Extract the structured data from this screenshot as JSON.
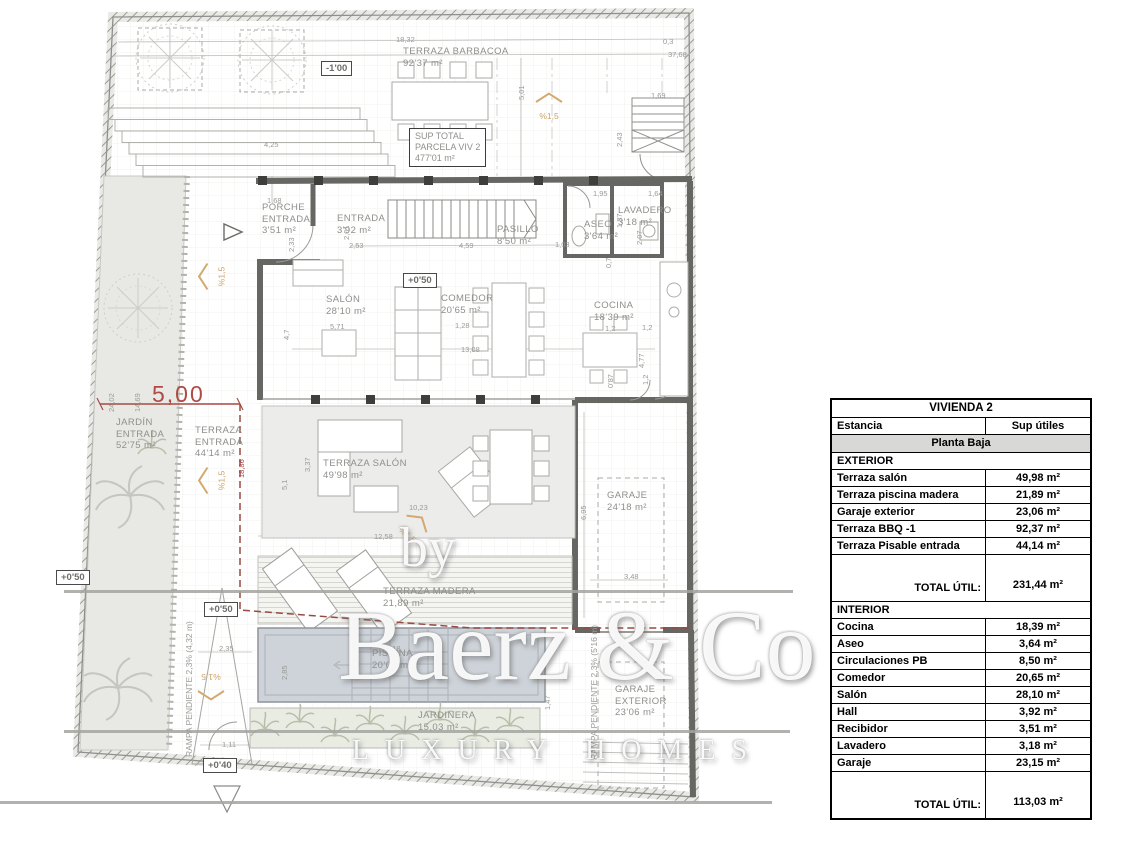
{
  "watermark": {
    "by": "by",
    "brand": "Baerz & Co",
    "tagline": "LUXURY HOMES"
  },
  "table": {
    "title": "VIVIENDA 2",
    "col_room": "Estancia",
    "col_area": "Sup útiles",
    "section_title": "Planta Baja",
    "groups": [
      {
        "header": "EXTERIOR",
        "rows": [
          [
            "Terraza salón",
            "49,98 m²"
          ],
          [
            "Terraza piscina madera",
            "21,89 m²"
          ],
          [
            "Garaje exterior",
            "23,06 m²"
          ],
          [
            "Terraza BBQ -1",
            "92,37 m²"
          ],
          [
            "Terraza Pisable entrada",
            "44,14 m²"
          ]
        ],
        "total_label": "TOTAL ÚTIL:",
        "total_value": "231,44  m²"
      },
      {
        "header": "INTERIOR",
        "rows": [
          [
            "Cocina",
            "18,39 m²"
          ],
          [
            "Aseo",
            "3,64 m²"
          ],
          [
            "Circulaciones PB",
            "8,50 m²"
          ],
          [
            "Comedor",
            "20,65 m²"
          ],
          [
            "Salón",
            "28,10 m²"
          ],
          [
            "Hall",
            "3,92 m²"
          ],
          [
            "Recibidor",
            "3,51 m²"
          ],
          [
            "Lavadero",
            "3,18 m²"
          ],
          [
            "Garaje",
            "23,15 m²"
          ]
        ],
        "total_label": "TOTAL ÚTIL:",
        "total_value": "113,03  m²"
      }
    ]
  },
  "plan": {
    "slope_text": "%1,5",
    "sup_total": {
      "lines": [
        "SUP TOTAL",
        "PARCELA VIV 2",
        "477'01 m²"
      ],
      "x": 409,
      "y": 128
    },
    "red_dim": {
      "t": "5,00",
      "x": 152,
      "y": 381
    },
    "rooms": [
      {
        "lines": [
          "TERRAZA BARBACOA",
          "92'37 m²"
        ],
        "x": 403,
        "y": 46
      },
      {
        "lines": [
          "PORCHE",
          "ENTRADA",
          "3'51 m²"
        ],
        "x": 262,
        "y": 202
      },
      {
        "lines": [
          "ENTRADA",
          "3'92 m²"
        ],
        "x": 337,
        "y": 213
      },
      {
        "lines": [
          "PASILLO",
          "8'50 m²"
        ],
        "x": 497,
        "y": 224
      },
      {
        "lines": [
          "ASEO",
          "3'64 m²"
        ],
        "x": 584,
        "y": 219
      },
      {
        "lines": [
          "LAVADERO",
          "3'18 m²"
        ],
        "x": 618,
        "y": 205
      },
      {
        "lines": [
          "SALÓN",
          "28'10 m²"
        ],
        "x": 326,
        "y": 294
      },
      {
        "lines": [
          "COMEDOR",
          "20'65 m²"
        ],
        "x": 441,
        "y": 293
      },
      {
        "lines": [
          "COCINA",
          "18'39 m²"
        ],
        "x": 594,
        "y": 300
      },
      {
        "lines": [
          "JARDÍN",
          "ENTRADA",
          "52'75 m²"
        ],
        "x": 116,
        "y": 417
      },
      {
        "lines": [
          "TERRAZA",
          "ENTRADA",
          "44'14 m²"
        ],
        "x": 195,
        "y": 425
      },
      {
        "lines": [
          "TERRAZA SALÓN",
          "49'98 m²"
        ],
        "x": 323,
        "y": 458
      },
      {
        "lines": [
          "GARAJE",
          "24'18 m²"
        ],
        "x": 607,
        "y": 490
      },
      {
        "lines": [
          "TERRAZA MADERA",
          "21,89 m²"
        ],
        "x": 383,
        "y": 586
      },
      {
        "lines": [
          "PISCINA",
          "20'04 m²"
        ],
        "x": 372,
        "y": 648
      },
      {
        "lines": [
          "JARDINERA",
          "15,03 m²"
        ],
        "x": 418,
        "y": 710
      },
      {
        "lines": [
          "GARAJE",
          "EXTERIOR",
          "23'06 m²"
        ],
        "x": 615,
        "y": 684
      }
    ],
    "levels": [
      {
        "t": "-1'00",
        "x": 321,
        "y": 61
      },
      {
        "t": "+0'50",
        "x": 403,
        "y": 273
      },
      {
        "t": "+0'50",
        "x": 56,
        "y": 570
      },
      {
        "t": "+0'50",
        "x": 204,
        "y": 602
      },
      {
        "t": "+0'40",
        "x": 203,
        "y": 758
      }
    ],
    "slopes": [
      {
        "x": 536,
        "y": 100,
        "rot": 0
      },
      {
        "x": 203,
        "y": 266,
        "rot": -90
      },
      {
        "x": 203,
        "y": 470,
        "rot": -90
      },
      {
        "x": 398,
        "y": 520,
        "rot": 40
      },
      {
        "x": 198,
        "y": 672,
        "rot": 180
      }
    ],
    "ramps": [
      {
        "t": "RAMPA PENDIENTE 2,3% (4,32 m)",
        "x": 184,
        "y": 757
      },
      {
        "t": "RAMPA PENDIENTE 2,3% (5'16 m)",
        "x": 589,
        "y": 760
      }
    ],
    "dims": [
      {
        "t": "18,32",
        "x": 396,
        "y": 36
      },
      {
        "t": "0,3",
        "x": 663,
        "y": 38
      },
      {
        "t": "37,68",
        "x": 668,
        "y": 51
      },
      {
        "t": "5,01",
        "x": 518,
        "y": 100,
        "r": -90
      },
      {
        "t": "4,25",
        "x": 264,
        "y": 141
      },
      {
        "t": "1,69",
        "x": 651,
        "y": 92
      },
      {
        "t": "2,43",
        "x": 616,
        "y": 147,
        "r": -90
      },
      {
        "t": "1,68",
        "x": 267,
        "y": 197
      },
      {
        "t": "2,33",
        "x": 288,
        "y": 252,
        "r": -90
      },
      {
        "t": "2,01",
        "x": 343,
        "y": 240,
        "r": -90
      },
      {
        "t": "2,53",
        "x": 349,
        "y": 242
      },
      {
        "t": "4,59",
        "x": 459,
        "y": 242
      },
      {
        "t": "1,03",
        "x": 555,
        "y": 241
      },
      {
        "t": "1,95",
        "x": 593,
        "y": 190
      },
      {
        "t": "1,64",
        "x": 648,
        "y": 190
      },
      {
        "t": "1,87",
        "x": 616,
        "y": 228,
        "r": -90
      },
      {
        "t": "2,07",
        "x": 636,
        "y": 245,
        "r": -90
      },
      {
        "t": "0,7",
        "x": 605,
        "y": 268,
        "r": -90
      },
      {
        "t": "5,71",
        "x": 330,
        "y": 323
      },
      {
        "t": "1,28",
        "x": 455,
        "y": 322
      },
      {
        "t": "13,08",
        "x": 461,
        "y": 346
      },
      {
        "t": "4,7",
        "x": 283,
        "y": 340,
        "r": -90
      },
      {
        "t": "1,2",
        "x": 605,
        "y": 325
      },
      {
        "t": "1,2",
        "x": 642,
        "y": 324
      },
      {
        "t": "4,77",
        "x": 638,
        "y": 368,
        "r": -90
      },
      {
        "t": "1,2",
        "x": 642,
        "y": 385,
        "r": -90
      },
      {
        "t": "0'87",
        "x": 607,
        "y": 388,
        "r": -90
      },
      {
        "t": "24,02",
        "x": 108,
        "y": 412,
        "r": -90
      },
      {
        "t": "14,69",
        "x": 134,
        "y": 412,
        "r": -90
      },
      {
        "t": "18,86",
        "x": 238,
        "y": 478,
        "r": -90,
        "red": true
      },
      {
        "t": "3,37",
        "x": 304,
        "y": 472,
        "r": -90
      },
      {
        "t": "5,1",
        "x": 281,
        "y": 490,
        "r": -90
      },
      {
        "t": "10,23",
        "x": 409,
        "y": 504
      },
      {
        "t": "12,58",
        "x": 374,
        "y": 533
      },
      {
        "t": "6,95",
        "x": 580,
        "y": 520,
        "r": -90
      },
      {
        "t": "3,48",
        "x": 624,
        "y": 573
      },
      {
        "t": "2,35",
        "x": 219,
        "y": 645
      },
      {
        "t": "2,85",
        "x": 281,
        "y": 680,
        "r": -90
      },
      {
        "t": "9,18",
        "x": 386,
        "y": 645
      },
      {
        "t": "1,47",
        "x": 544,
        "y": 710,
        "r": -90
      },
      {
        "t": "1,11",
        "x": 222,
        "y": 741
      }
    ]
  }
}
